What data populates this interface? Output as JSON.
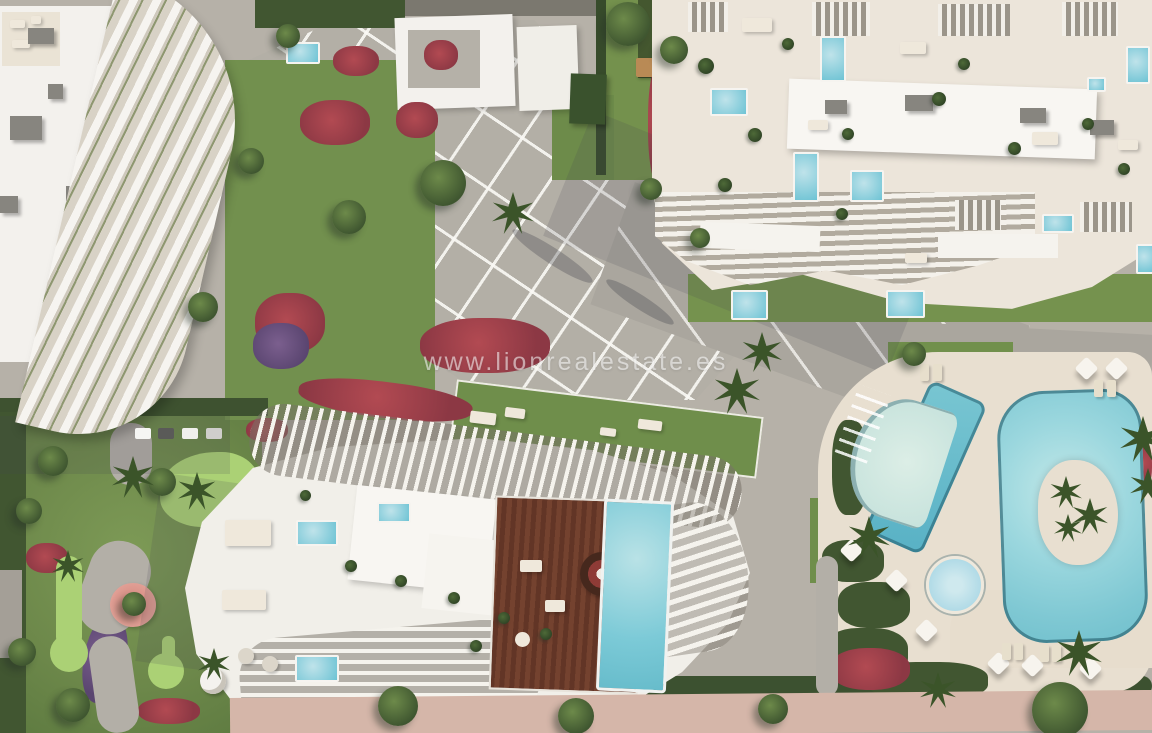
{
  "watermark": {
    "text": "www.lionrealestate.es"
  },
  "scene": {
    "description": "Aerial 3D render of a beachfront residential complex: three white apartment buildings with wavy balcony fins, rooftop terraces with private plunge pools, a central paved plaza, communal lagoon pool with palm island, lap pool, kids pool, mini-golf garden, wooden penthouse deck with infinity pool and a pink seaside promenade",
    "palette": {
      "paving": "#b6b1a8",
      "plaza_line": "#f7f6f2",
      "building_white": "#f3f1ed",
      "terrace_cream": "#ece5da",
      "roof_slab": "#f8f6f2",
      "pool_main": "#8fd2db",
      "lap_pool": "#5fb6c9",
      "shallow_pool": "#ccdcd2",
      "lawn": "#72904e",
      "putting_green": "#abd175",
      "hedge": "#415631",
      "flowers_red": "#a8404e",
      "flowers_purple": "#6b5380",
      "wood_deck": "#70402e",
      "deck_cream": "#e8dfd0",
      "promenade_pink": "#d5b6a9",
      "planter_pink": "#e2a49b"
    }
  }
}
